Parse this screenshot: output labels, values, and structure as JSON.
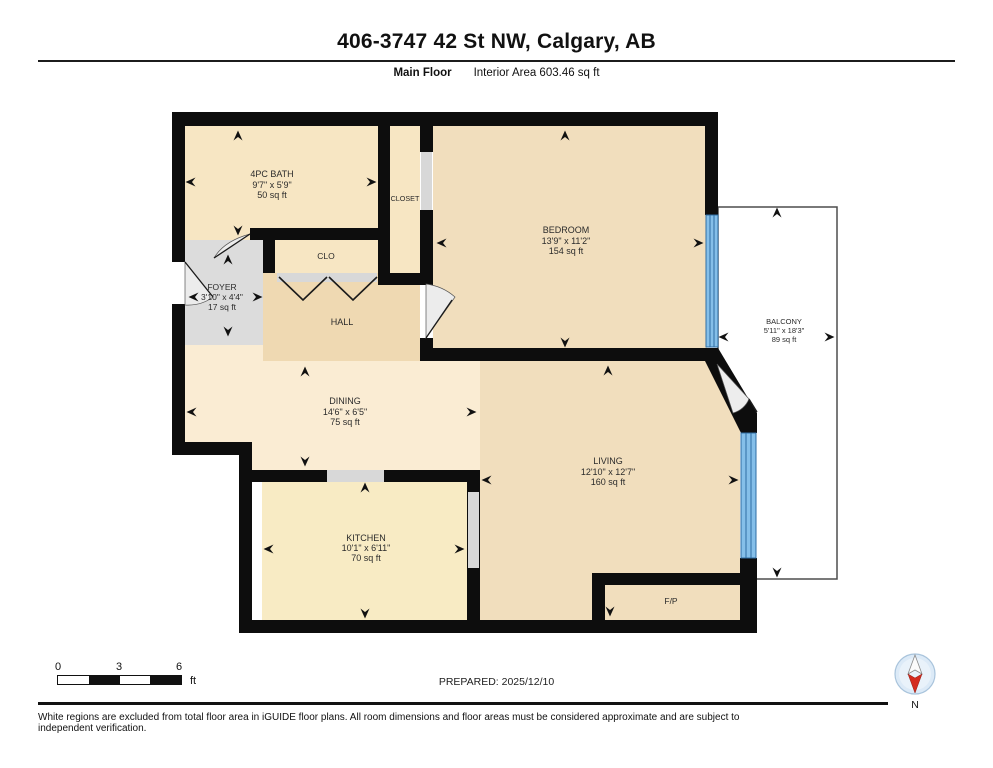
{
  "header": {
    "title": "406-3747 42 St NW, Calgary, AB",
    "floor_label": "Main Floor",
    "area_label": "Interior Area 603.46 sq ft"
  },
  "rooms": {
    "bath": {
      "name": "4PC BATH",
      "dims": "9'7\" x 5'9\"",
      "area": "50 sq ft"
    },
    "closet": {
      "name": "CLOSET"
    },
    "clo": {
      "name": "CLO"
    },
    "foyer": {
      "name": "FOYER",
      "dims": "3'10\" x 4'4\"",
      "area": "17 sq ft"
    },
    "hall": {
      "name": "HALL"
    },
    "bedroom": {
      "name": "BEDROOM",
      "dims": "13'9\" x 11'2\"",
      "area": "154 sq ft"
    },
    "balcony": {
      "name": "BALCONY",
      "dims": "5'11\" x 18'3\"",
      "area": "89 sq ft"
    },
    "dining": {
      "name": "DINING",
      "dims": "14'6\" x 6'5\"",
      "area": "75 sq ft"
    },
    "living": {
      "name": "LIVING",
      "dims": "12'10\" x 12'7\"",
      "area": "160 sq ft"
    },
    "kitchen": {
      "name": "KITCHEN",
      "dims": "10'1\" x 6'11\"",
      "area": "70 sq ft"
    },
    "fireplace": {
      "name": "F/P"
    }
  },
  "footer": {
    "scale": {
      "ticks": [
        "0",
        "3",
        "6"
      ],
      "unit": "ft"
    },
    "prepared": "PREPARED: 2025/12/10",
    "compass_label": "N",
    "disclaimer": "White regions are excluded from total floor area in iGUIDE floor plans. All room dimensions and floor areas must be considered approximate and are subject to independent verification."
  },
  "colors": {
    "wall": "#0d0d0d",
    "window": "#85BFE9",
    "window_frame": "#2E6DA4",
    "room_cream": "#F7E6C3",
    "room_tan": "#F1DEBD",
    "room_light_cream": "#FAECD3",
    "hall_tan": "#EFD9B2",
    "foyer_gray": "#DCDCDC",
    "opening_gray": "#D8D8D8",
    "compass_red": "#D42B1E"
  }
}
